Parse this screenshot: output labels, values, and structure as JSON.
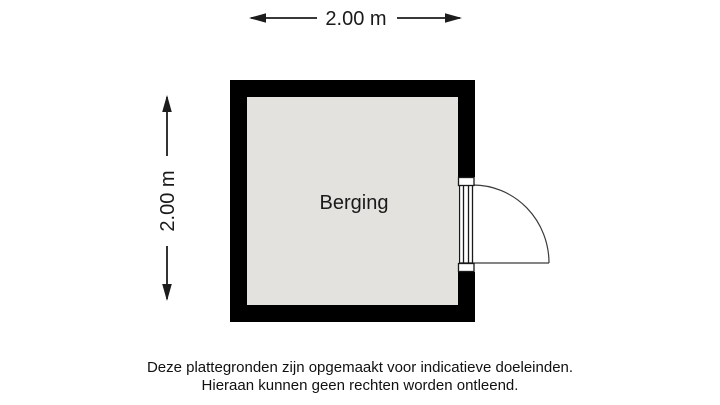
{
  "floorplan": {
    "room": {
      "label": "Berging",
      "floor_fill": "#e3e2de",
      "wall_color": "#000000"
    },
    "dimensions": {
      "top": {
        "label": "2.00 m"
      },
      "left": {
        "label": "2.00 m"
      }
    },
    "door": {
      "wall": "right",
      "type": "single-swing-outward"
    },
    "disclaimer": {
      "line1": "Deze plattegronden zijn opgemaakt voor indicatieve doeleinden.",
      "line2": "Hieraan kunnen geen rechten worden ontleend."
    }
  }
}
